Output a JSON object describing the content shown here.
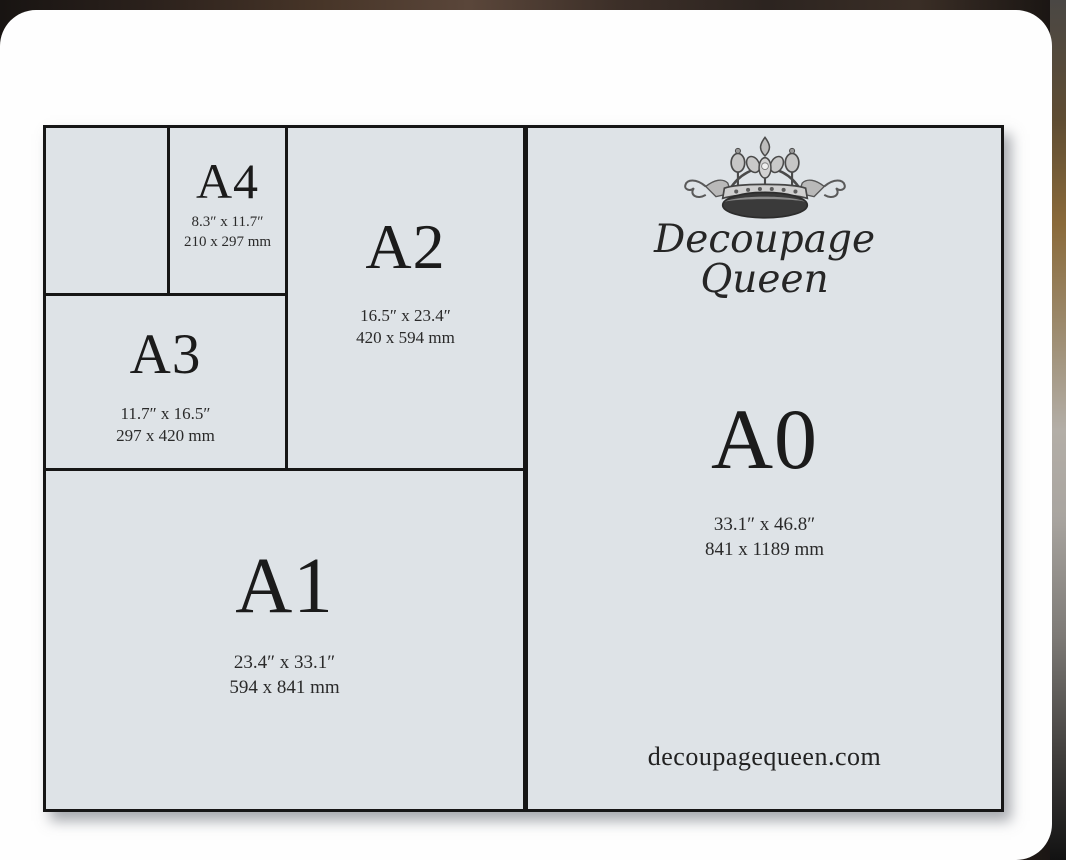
{
  "brand": {
    "name_line1": "Decoupage",
    "name_line2": "Queen",
    "website": "decoupagequeen.com"
  },
  "colors": {
    "paper_fill": "#dee3e7",
    "grid_line": "#161616",
    "text": "#1b1b1b",
    "card": "#fefefe"
  },
  "diagram_title": "A-series paper size comparison",
  "sizes": [
    {
      "id": "A4",
      "label": "A4",
      "inches": "8.3″ x 11.7″",
      "mm": "210 x 297 mm"
    },
    {
      "id": "A3",
      "label": "A3",
      "inches": "11.7″ x 16.5″",
      "mm": "297 x 420 mm"
    },
    {
      "id": "A2",
      "label": "A2",
      "inches": "16.5″ x 23.4″",
      "mm": "420 x 594 mm"
    },
    {
      "id": "A1",
      "label": "A1",
      "inches": "23.4″ x 33.1″",
      "mm": "594 x 841 mm"
    },
    {
      "id": "A0",
      "label": "A0",
      "inches": "33.1″ x 46.8″",
      "mm": "841 x 1189 mm"
    }
  ]
}
